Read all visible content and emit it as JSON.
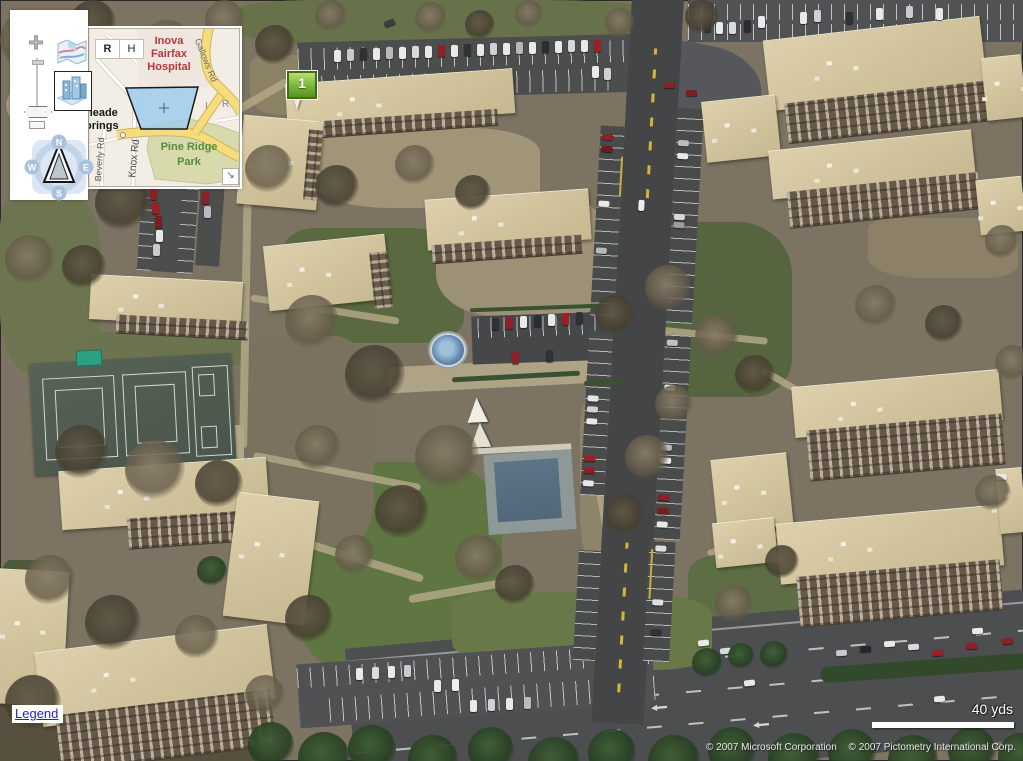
{
  "theme": {
    "link": "#2323cc",
    "pin_fill": "#79b33b",
    "pin_hi": "#b9e068",
    "pin_border": "#3f6d1d",
    "hospital_text": "#b23a3c",
    "park_text": "#588a3c",
    "road_yellow": "#f2d878",
    "view_frustum": "#9ecdeb",
    "scale_bar": "#ffffff"
  },
  "nav": {
    "zoom_in": "+",
    "zoom_out": "−"
  },
  "compass": {
    "n": "N",
    "e": "E",
    "s": "S",
    "w": "W"
  },
  "inset": {
    "road_button": "R",
    "hybrid_button": "H",
    "resize_icon": "↘",
    "labels": {
      "hospital_1": "Inova",
      "hospital_2": "Fairfax",
      "hospital_3": "Hospital",
      "gallows": "Gallows Rd",
      "place_1": "neade",
      "place_2": "orings",
      "beverly": "Beverly Rd",
      "knox": "Knox Rd",
      "park_1": "Pine Ridge",
      "park_2": "Park",
      "partial_i": "I",
      "partial_r": "R"
    }
  },
  "pushpin": {
    "label": "1"
  },
  "legend_label": "Legend",
  "scale_label": "40 yds",
  "copyright": {
    "microsoft": "© 2007 Microsoft Corporation",
    "pictometry": "© 2007 Pictometry International Corp."
  }
}
